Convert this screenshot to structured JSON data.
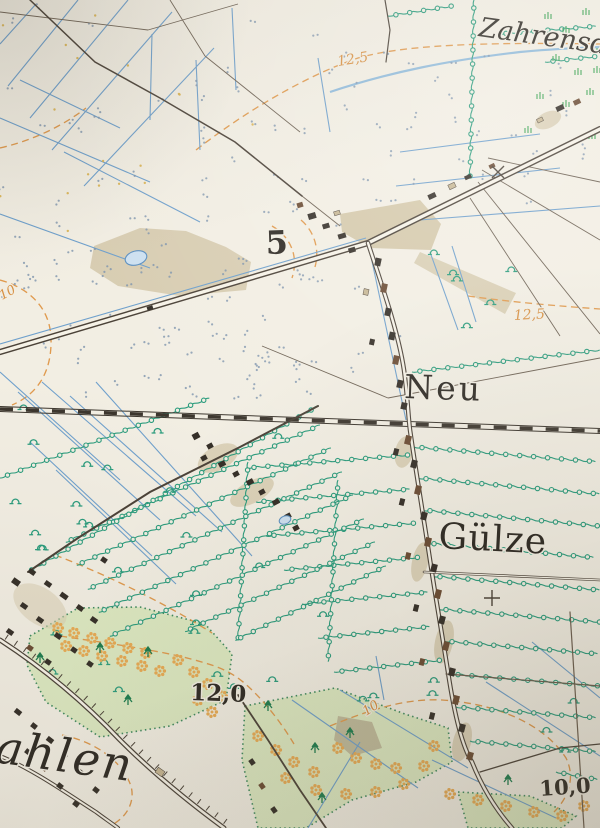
{
  "map": {
    "labels": {
      "place_top_right": "Zahrensd",
      "road_number": "5",
      "place_neu": "Neu",
      "place_guelze": "Gülze",
      "place_bottom_left": "ahlen",
      "elevation_12_0": "12,0",
      "elevation_10_0": "10,0",
      "contour_12_5_top": "12,5",
      "contour_12_5_right": "12,5",
      "contour_10_left": "10",
      "contour_10_bottom": "10"
    },
    "colors": {
      "paper": "#f2eee3",
      "contour_orange": "#d89042",
      "water_blue": "#6fa0cc",
      "hedge_green": "#2b9c7d",
      "vegetation_fill": "#dde9c2",
      "road_dark": "#4b4238",
      "building_dark": "#352f28",
      "building_brown": "#6b4c34",
      "bush_orange": "#e8ab55",
      "open_ground_tan": "#d8cdb2"
    }
  }
}
